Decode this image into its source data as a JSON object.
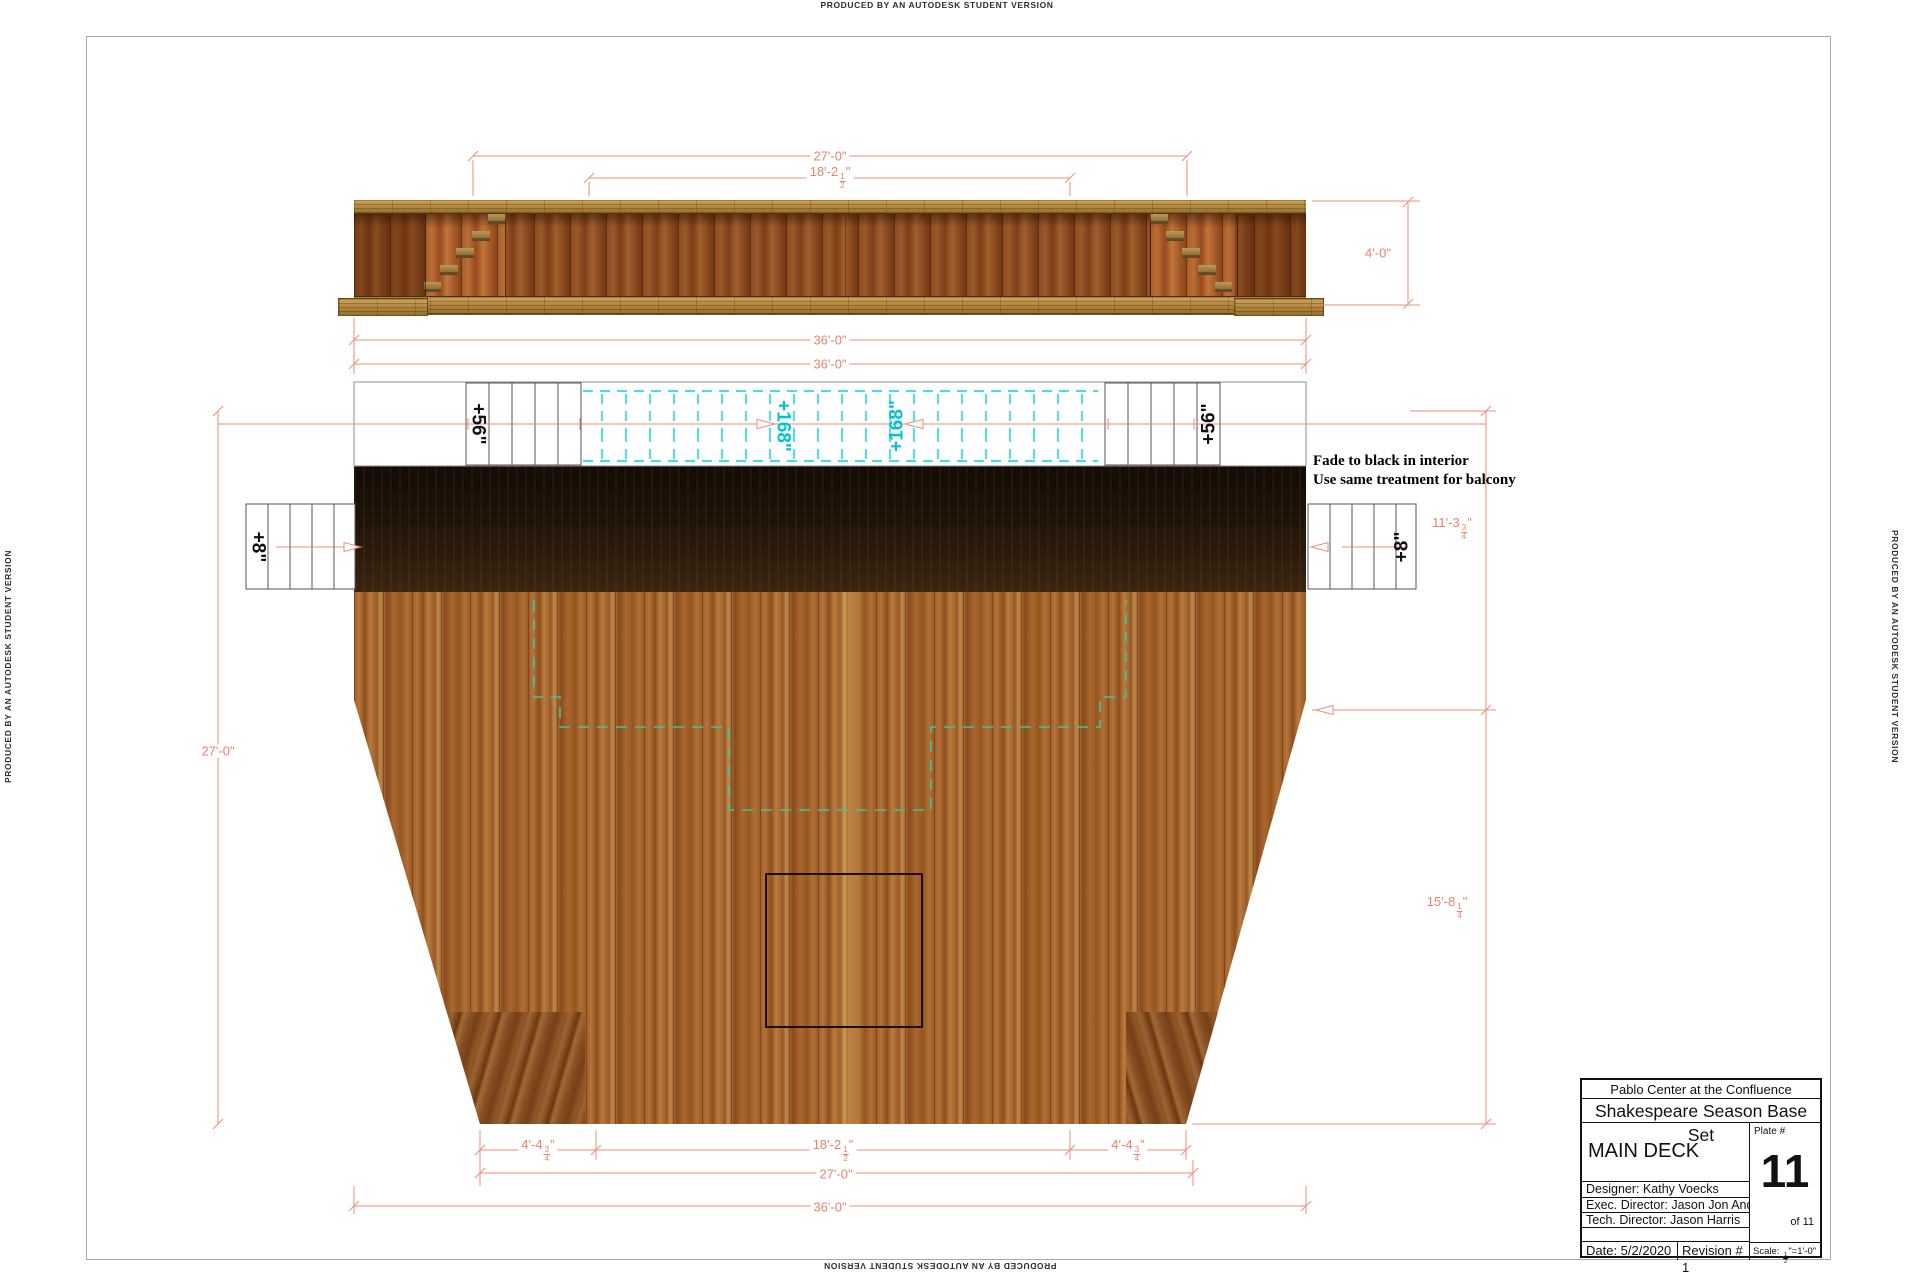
{
  "watermark": {
    "text": "PRODUCED BY AN AUTODESK STUDENT VERSION"
  },
  "note": {
    "line1": "Fade to black in interior",
    "line2": "Use same treatment for balcony"
  },
  "labels": {
    "balcony_left_height": "+56\"",
    "balcony_right_height": "+56\"",
    "interior_left_height": "+168\"",
    "interior_right_height": "+168\"",
    "side_stair_left_height": "+8\"",
    "side_stair_right_height": "+8\""
  },
  "dims": {
    "elev_top_27": "27'-0\"",
    "elev_top_18": {
      "pre": "18'-2",
      "num": "1",
      "den": "2",
      "suf": "\""
    },
    "elev_height": "4'-0\"",
    "elev_width_36": "36'-0\"",
    "plan_width_36": "36'-0\"",
    "plan_left_27": "27'-0\"",
    "plan_right_11": {
      "pre": "11'-3",
      "num": "3",
      "den": "4",
      "suf": "\""
    },
    "plan_right_15": {
      "pre": "15'-8",
      "num": "1",
      "den": "4",
      "suf": "\""
    },
    "bottom_4l": {
      "pre": "4'-4",
      "num": "3",
      "den": "4",
      "suf": "\""
    },
    "bottom_18": {
      "pre": "18'-2",
      "num": "1",
      "den": "2",
      "suf": "\""
    },
    "bottom_4r": {
      "pre": "4'-4",
      "num": "3",
      "den": "4",
      "suf": "\""
    },
    "bottom_27": "27'-0\"",
    "bottom_36": "36'-0\""
  },
  "title_block": {
    "venue": "Pablo Center at the Confluence",
    "production": "Shakespeare Season Base Set",
    "sheet_title": "MAIN DECK",
    "plate_label": "Plate #",
    "plate_number": "11",
    "plate_of": "of 11",
    "designer": "Designer: Kathy Voecks",
    "exec_director": "Exec. Director: Jason Jon Anderson",
    "tech_director": "Tech. Director: Jason Harris",
    "date": "Date: 5/2/2020",
    "revision": "Revision # 1",
    "scale_prefix": "Scale: ",
    "scale_num": "1",
    "scale_den": "2",
    "scale_suffix": "\"=1'-0\""
  },
  "colors": {
    "dimension": "#e8836b",
    "balcony_dash": "#00d5de",
    "deck_hidden_line": "#3fc39e",
    "note_text": "#000000"
  }
}
